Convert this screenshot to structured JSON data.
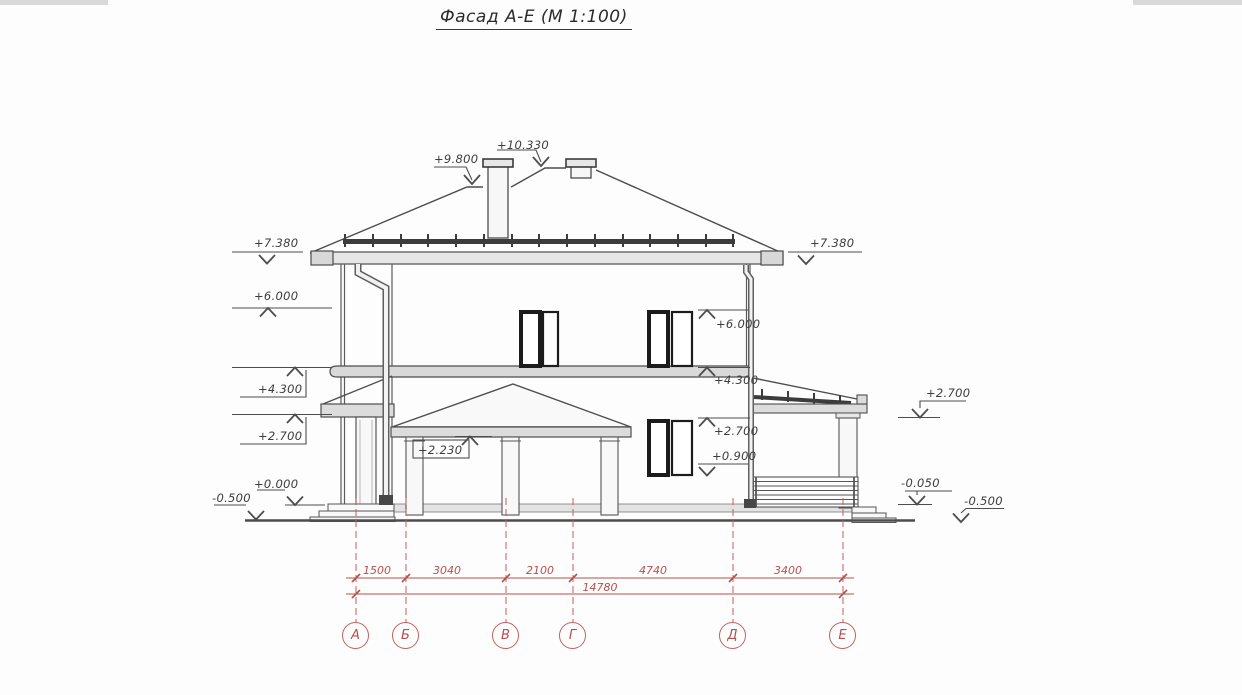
{
  "title": "Фасад А-Е (М 1:100)",
  "drawing": {
    "type": "building facade elevation",
    "scale": "М 1:100",
    "axis_range": "А-Е"
  },
  "elevation_marks": {
    "ridge": "+10.330",
    "roof_break": "+9.800",
    "eaves_left": "+7.380",
    "eaves_right": "+7.380",
    "level_6000_left": "+6.000",
    "level_6000_inner": "+6.000",
    "level_4300_left": "+4.300",
    "level_4300_inner": "+4.300",
    "level_2700_left": "+2.700",
    "level_2700_inner": "+2.700",
    "level_2700_terrace": "+2.700",
    "porch_canopy": "+2.230",
    "window_sill_inner": "+0.900",
    "zero_level": "+0.000",
    "terrace_floor": "-0.050",
    "ground_left": "-0.500",
    "ground_right": "-0.500"
  },
  "dimensions": {
    "segments": [
      "1500",
      "3040",
      "2100",
      "4740",
      "3400"
    ],
    "total": "14780"
  },
  "axes": [
    "А",
    "Б",
    "В",
    "Г",
    "Д",
    "Е"
  ],
  "colors": {
    "line": "#4d4d4d",
    "dimension_red": "#b5504c",
    "text": "#3d3d3d",
    "paper": "#fdfdfd"
  }
}
